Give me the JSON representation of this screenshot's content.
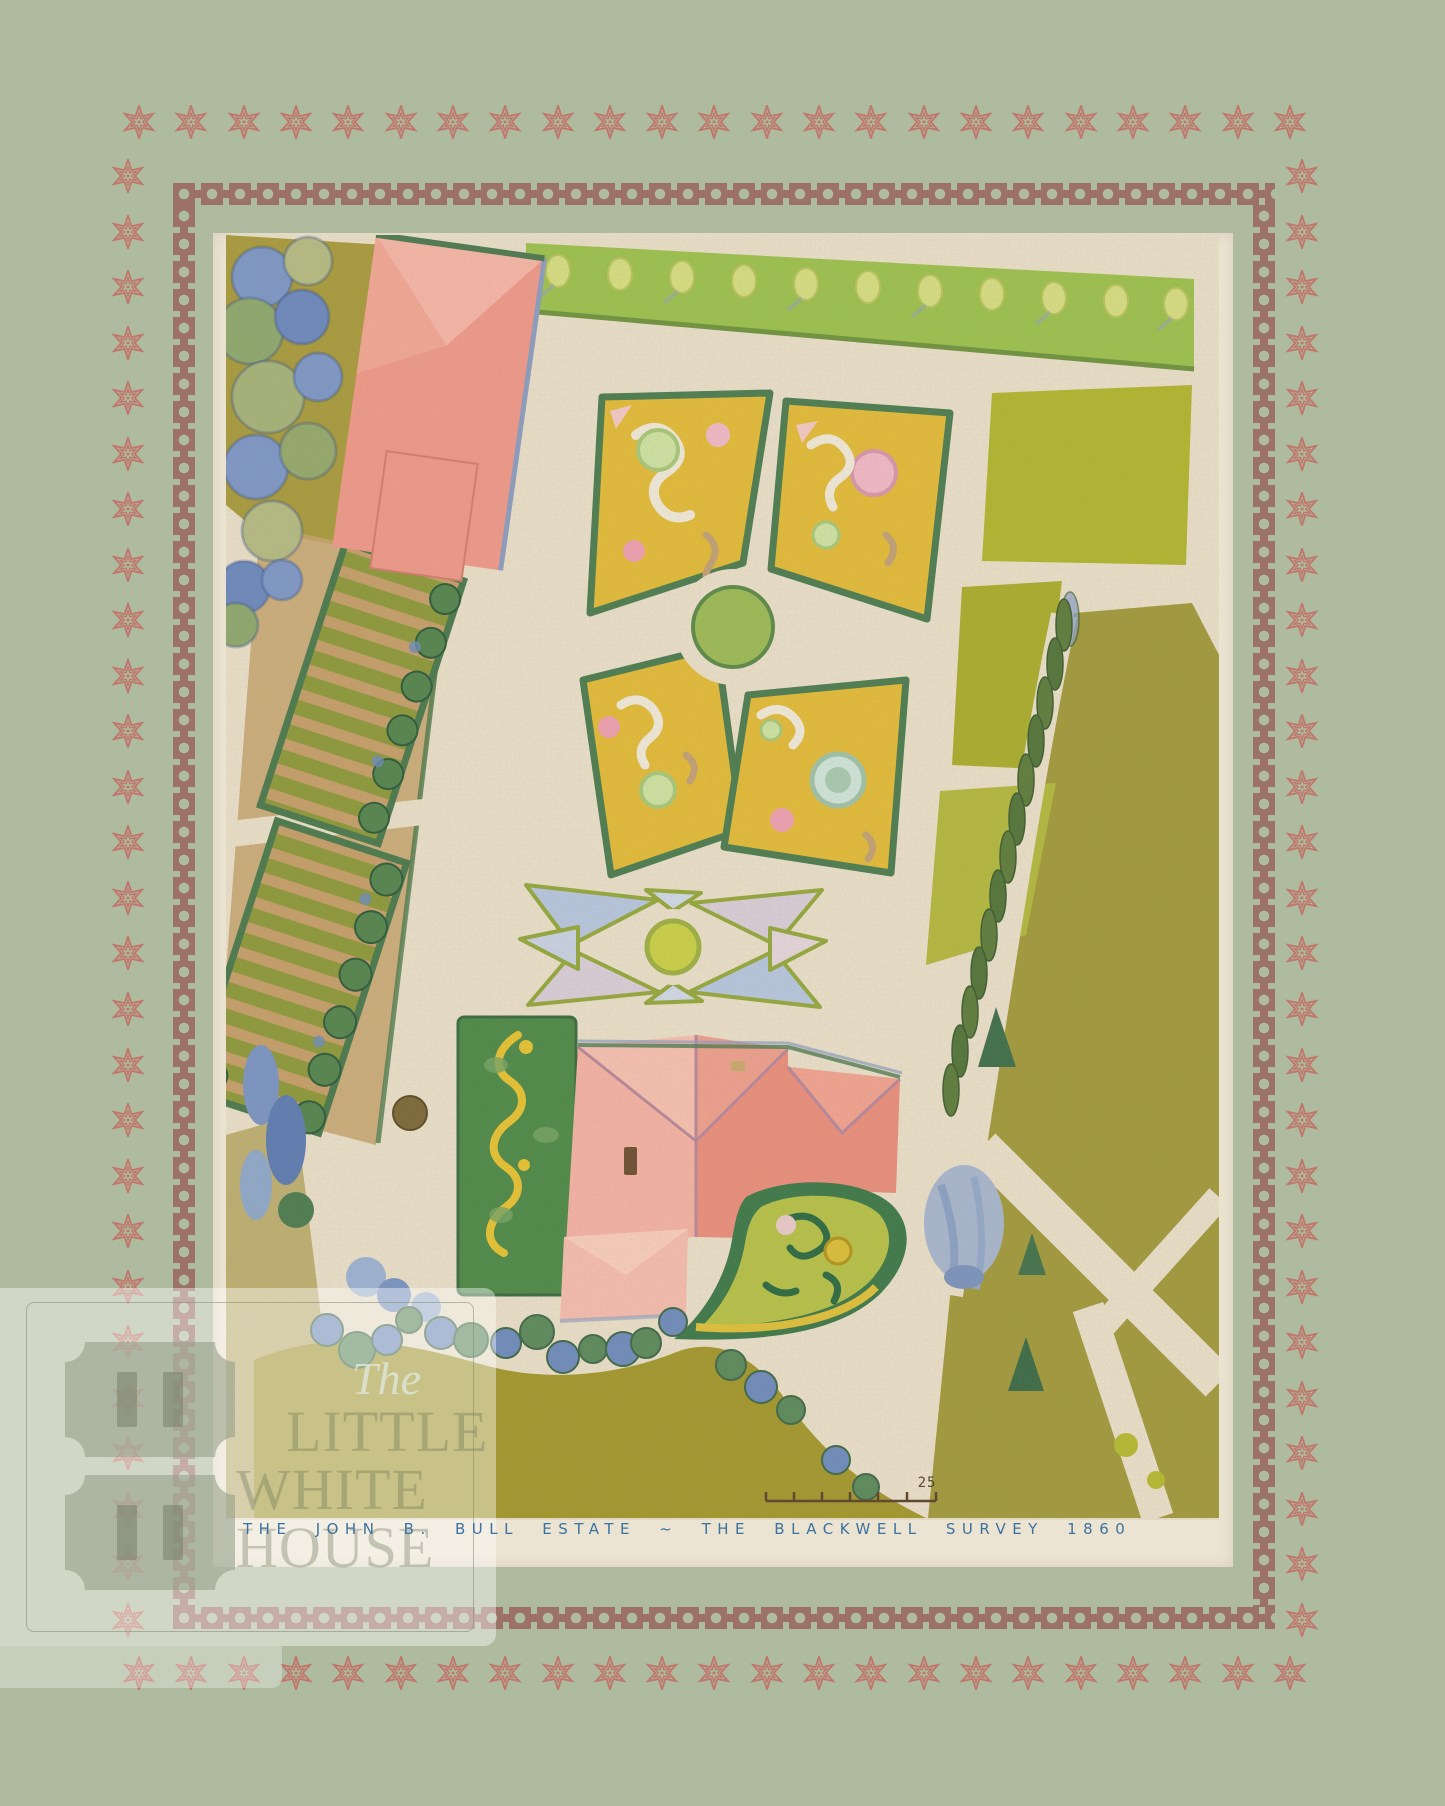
{
  "artwork": {
    "caption": "THE JOHN B. BULL ESTATE ~ THE BLACKWELL SURVEY 1860",
    "scale_label": "25"
  },
  "watermark": {
    "script_word": "The",
    "line1": "LITTLE",
    "line2": "WHITE",
    "line3": "HOUSE"
  },
  "palette": {
    "sage": "#aebb9e",
    "star_rose": "#c0766c",
    "chain_mauve": "#9b7168",
    "mat_cream": "#ece4d2",
    "paper_cream": "#e9dfc9",
    "caption_blue": "#3c72a0",
    "salmon": "#e98f7d",
    "salmon_light": "#f3b2a4",
    "hedge_green": "#4c7a4e",
    "chartreuse": "#b0b631",
    "olive_gold": "#a29a3e",
    "parterre_yellow": "#e2bb3a",
    "tree_blue": "#6f8cbc",
    "scroll_yellow": "#e5c234"
  },
  "borders": {
    "star_top_count": 23,
    "star_bottom_count": 23,
    "star_side_count": 27
  }
}
